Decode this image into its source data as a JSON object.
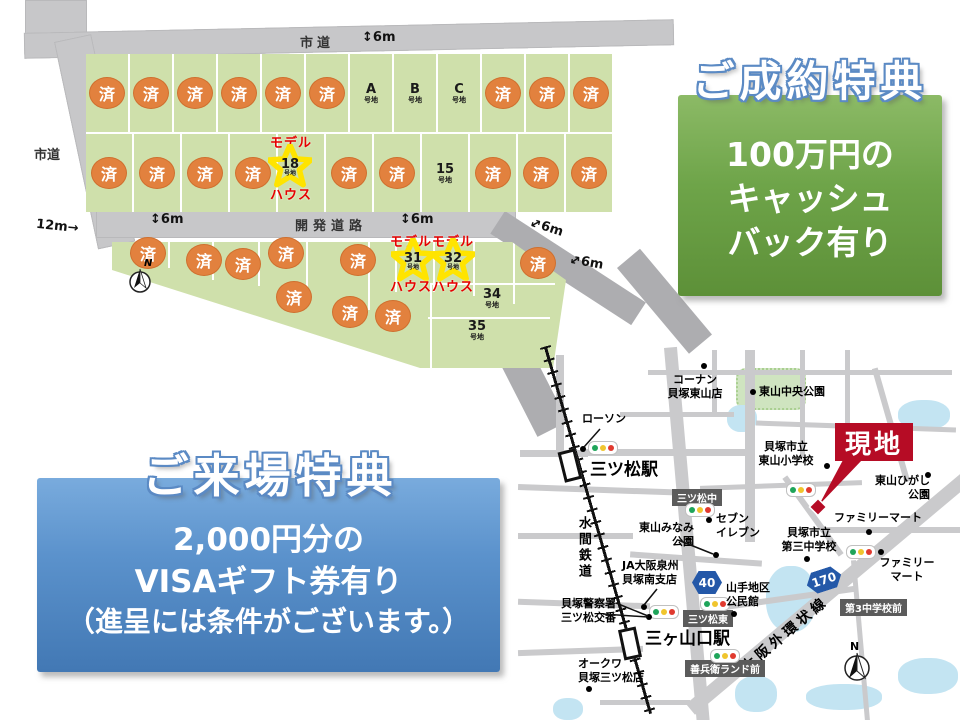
{
  "site_plan": {
    "road_top_label": "市道",
    "road_left_label": "市道",
    "road_mid_label": "開発道路",
    "dim_6m": "6m",
    "dim_12m": "12m",
    "arrow_v": "↕",
    "arrow_d": "↔",
    "arrow_r": "→",
    "sold": "済",
    "suffix": "号地",
    "model": "モデル",
    "house": "ハウス",
    "compass_n": "N",
    "row1": [
      "済",
      "済",
      "済",
      "済",
      "済",
      "済",
      "A",
      "B",
      "C",
      "済",
      "済",
      "済"
    ],
    "row2": [
      "済",
      "済",
      "済",
      "済",
      "18",
      "済",
      "済",
      "15",
      "済",
      "済",
      "済"
    ],
    "row3": [
      "済",
      "済",
      "済",
      "済",
      "済",
      "31",
      "32",
      "済"
    ],
    "row4": [
      "済",
      "済",
      "済",
      "34",
      "35"
    ]
  },
  "contract_benefit": {
    "title": "ご成約特典",
    "line1": "100万円の",
    "line2": "キャッシュ",
    "line3": "バック有り",
    "color": "#6ea449"
  },
  "visit_benefit": {
    "title": "ご来場特典",
    "line1": "2,000円分の",
    "line2": "VISAギフト券有り",
    "line3": "（進呈には条件がございます。）",
    "color": "#5b92cc"
  },
  "map": {
    "station1": "三ツ松駅",
    "station2": "三ヶ山口駅",
    "railway": "水間鉄道",
    "ring_road": "大阪外環状線",
    "badge40": "40",
    "badge170": "170",
    "stop1": "三ツ松中",
    "stop2": "三ツ松東",
    "stop3": "善兵衛ランド前",
    "stop4": "第3中学校前",
    "site_label": "現地",
    "compass_n": "N",
    "poi_konan_1": "コーナン",
    "poi_konan_2": "貝塚東山店",
    "poi_chuo_park": "東山中央公園",
    "poi_lawson": "ローソン",
    "poi_elem_1": "貝塚市立",
    "poi_elem_2": "東山小学校",
    "poi_higashi_park_1": "東山ひがし",
    "poi_higashi_park_2": "公園",
    "poi_famima1": "ファミリーマート",
    "poi_junior_1": "貝塚市立",
    "poi_junior_2": "第三中学校",
    "poi_famima2_1": "ファミリー",
    "poi_famima2_2": "マート",
    "poi_seven_1": "セブン",
    "poi_seven_2": "イレブン",
    "poi_minami_park_1": "東山みなみ",
    "poi_minami_park_2": "公園",
    "poi_ja_1": "JA大阪泉州",
    "poi_ja_2": "貝塚南支店",
    "poi_community_1": "山手地区",
    "poi_community_2": "公民館",
    "poi_police_1": "貝塚警察署",
    "poi_police_2": "三ツ松交番",
    "poi_okuwa_1": "オークワ",
    "poi_okuwa_2": "貝塚三ツ松店"
  }
}
